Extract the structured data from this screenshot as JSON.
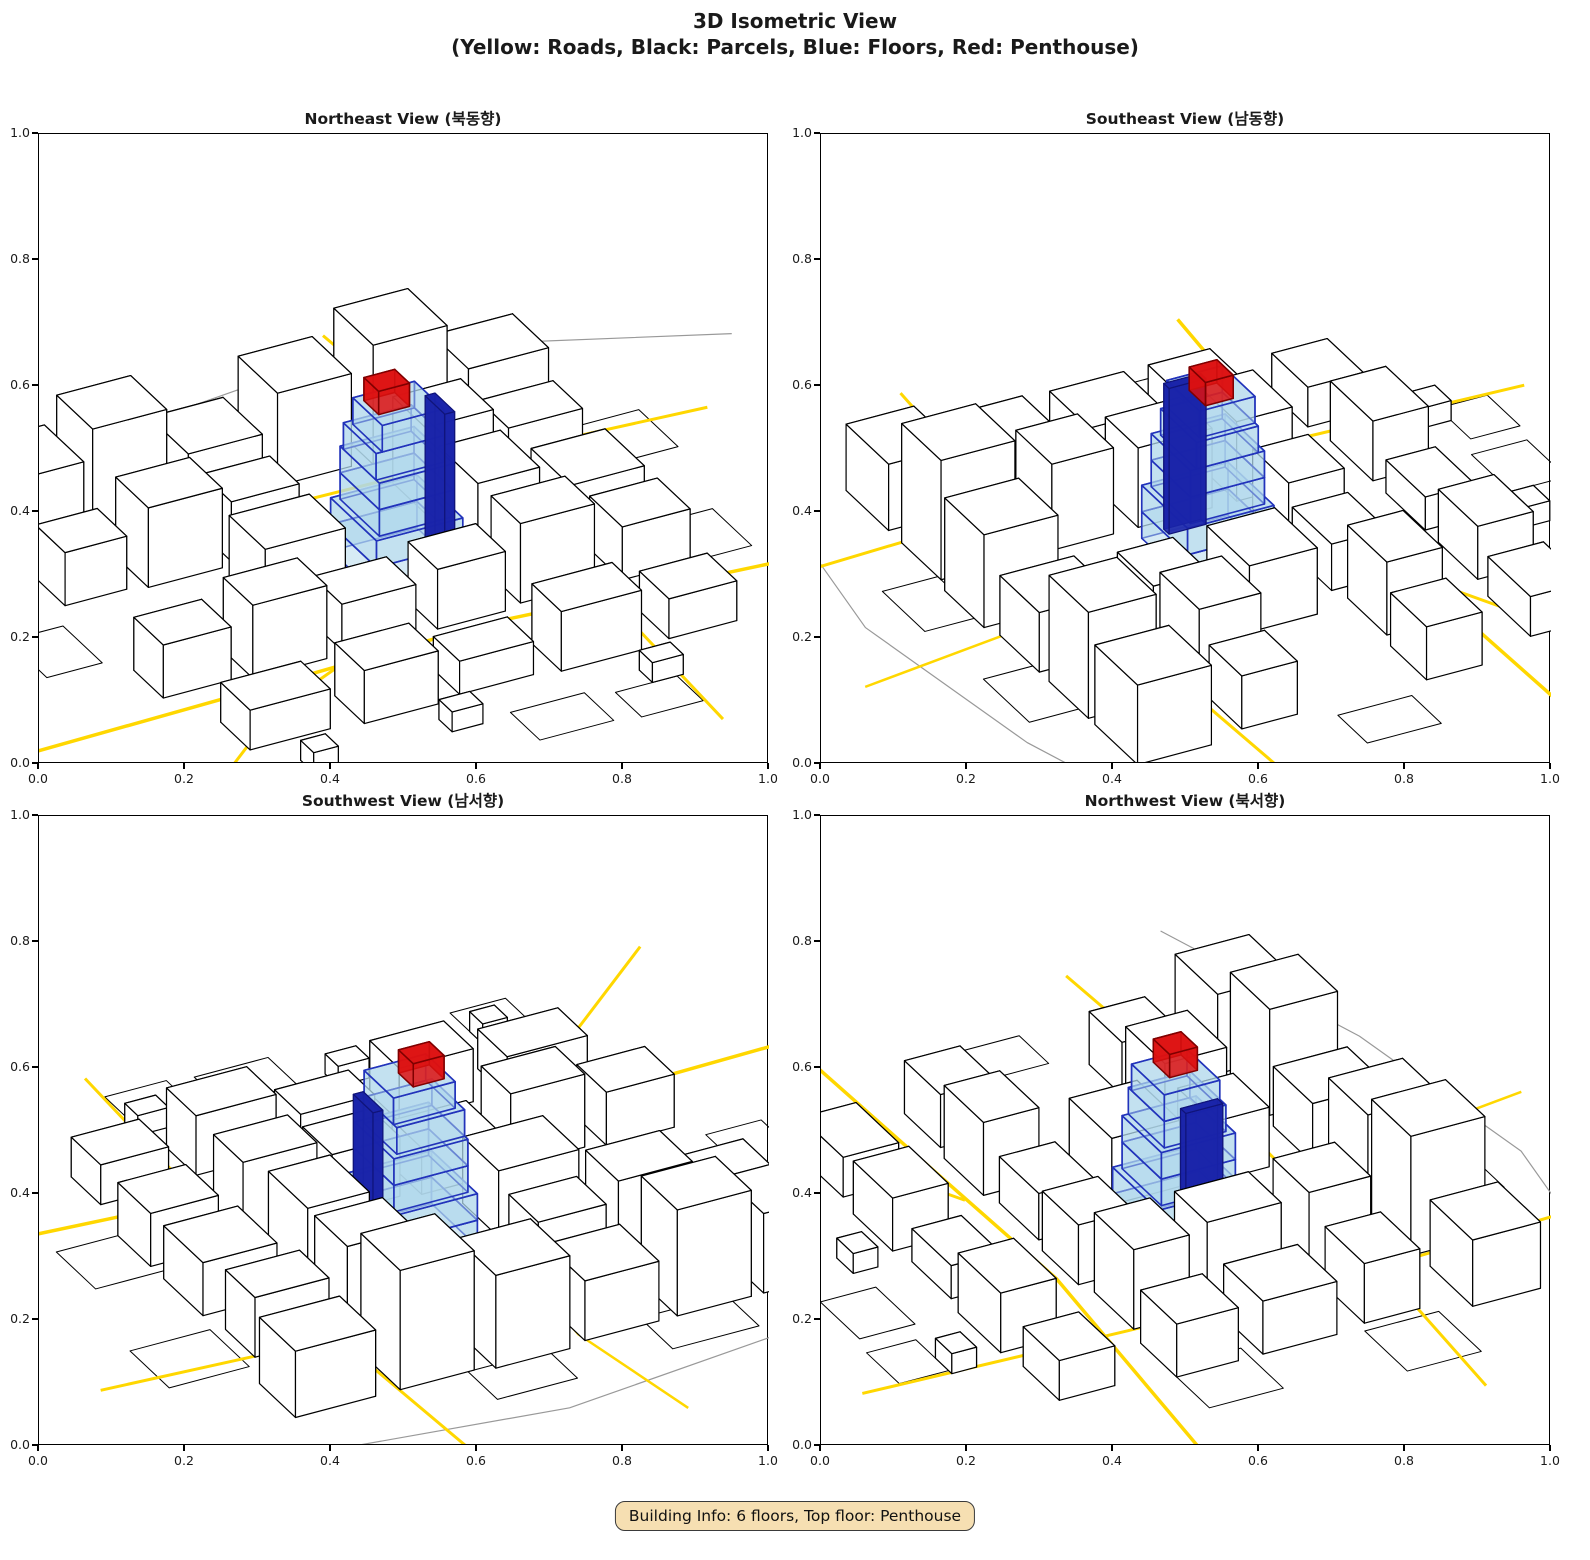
{
  "figure": {
    "title_line1": "3D Isometric View",
    "title_line2": "(Yellow: Roads, Black: Parcels, Blue: Floors, Red: Penthouse)"
  },
  "badge": {
    "text": "Building Info: 6 floors, Top floor: Penthouse"
  },
  "axes": {
    "ticks": [
      "0.0",
      "0.2",
      "0.4",
      "0.6",
      "0.8",
      "1.0"
    ]
  },
  "views": [
    {
      "id": "northeast",
      "title": "Northeast View (북동향)",
      "azimuth": 28,
      "origin": [
        0.49,
        0.68
      ]
    },
    {
      "id": "southeast",
      "title": "Southeast View (남동향)",
      "azimuth": 118,
      "origin": [
        0.53,
        0.66
      ]
    },
    {
      "id": "southwest",
      "title": "Southwest View (남서향)",
      "azimuth": 208,
      "origin": [
        0.51,
        0.67
      ]
    },
    {
      "id": "northwest",
      "title": "Northwest View (북서향)",
      "azimuth": 298,
      "origin": [
        0.49,
        0.66
      ]
    }
  ],
  "colors": {
    "road": "#FFD700",
    "parcel_line": "#000000",
    "building_fill": "#FFFFFF",
    "building_edge": "#000000",
    "floor_fill": "rgba(176,216,235,0.5)",
    "floor_edge": "#2233BB",
    "core_fill": "rgba(25,35,170,0.9)",
    "core_edge": "#10147A",
    "penthouse_fill": "rgba(221,17,17,0.85)",
    "penthouse_edge": "#7F0000",
    "boundary": "#999999"
  },
  "city": {
    "scale": 7.0,
    "tilt": 0.5,
    "hz": 0.95,
    "center": [
      52,
      50
    ],
    "roads": [
      {
        "width": 3.5,
        "pts": [
          [
            -20,
            26
          ],
          [
            20,
            27
          ],
          [
            56,
            28
          ],
          [
            112,
            23
          ]
        ]
      },
      {
        "width": 3.0,
        "pts": [
          [
            -16,
            -8
          ],
          [
            16,
            20
          ],
          [
            30,
            27
          ]
        ]
      },
      {
        "width": 3.0,
        "pts": [
          [
            -20,
            70
          ],
          [
            30,
            72
          ],
          [
            70,
            71
          ],
          [
            112,
            68
          ]
        ]
      },
      {
        "width": 3.0,
        "pts": [
          [
            72,
            -12
          ],
          [
            74,
            30
          ],
          [
            75,
            70
          ],
          [
            73,
            112
          ]
        ]
      },
      {
        "width": 2.5,
        "pts": [
          [
            40,
            112
          ],
          [
            44,
            86
          ],
          [
            43,
            74
          ]
        ]
      }
    ],
    "boundaries": [
      {
        "width": 1.2,
        "pts": [
          [
            -25,
            88
          ],
          [
            15,
            99
          ],
          [
            55,
            104
          ],
          [
            95,
            98
          ],
          [
            125,
            85
          ]
        ]
      }
    ],
    "parcels": [
      [
        46,
        -5,
        12,
        9
      ],
      [
        62,
        -6,
        10,
        8
      ],
      [
        8,
        -4,
        9,
        7
      ],
      [
        86,
        30,
        13,
        12
      ],
      [
        -8,
        44,
        9,
        12
      ],
      [
        90,
        60,
        13,
        12
      ],
      [
        20,
        86,
        14,
        10
      ],
      [
        50,
        88,
        13,
        9
      ]
    ],
    "buildings": [
      [
        2,
        76,
        13,
        12,
        12
      ],
      [
        17,
        77,
        12,
        11,
        16
      ],
      [
        32,
        76,
        12,
        12,
        9
      ],
      [
        47,
        77,
        12,
        12,
        14
      ],
      [
        62,
        76,
        12,
        12,
        18
      ],
      [
        78,
        77,
        13,
        11,
        10
      ],
      [
        4,
        61,
        10,
        9,
        8
      ],
      [
        17,
        60,
        12,
        10,
        12
      ],
      [
        31,
        61,
        11,
        9,
        9
      ],
      [
        62,
        60,
        11,
        10,
        13
      ],
      [
        76,
        61,
        12,
        9,
        9
      ],
      [
        28,
        45,
        13,
        11,
        10
      ],
      [
        62,
        44,
        10,
        12,
        12
      ],
      [
        77,
        44,
        12,
        12,
        8
      ],
      [
        4,
        31,
        11,
        9,
        8
      ],
      [
        18,
        30,
        12,
        9,
        11
      ],
      [
        33,
        31,
        12,
        9,
        7
      ],
      [
        48,
        30,
        11,
        9,
        9
      ],
      [
        62,
        31,
        12,
        9,
        12
      ],
      [
        78,
        30,
        11,
        10,
        8
      ],
      [
        8,
        12,
        13,
        9,
        6
      ],
      [
        26,
        11,
        12,
        9,
        8
      ],
      [
        42,
        12,
        12,
        8,
        5
      ],
      [
        58,
        11,
        13,
        9,
        9
      ],
      [
        76,
        12,
        11,
        9,
        6
      ],
      [
        36,
        3,
        5,
        4,
        3
      ],
      [
        13,
        2,
        4,
        4,
        3
      ],
      [
        68,
        2,
        5,
        4,
        3
      ]
    ],
    "subject": {
      "floors": [
        [
          45,
          43,
          14,
          14,
          0,
          4
        ],
        [
          45,
          43,
          14,
          14,
          4,
          8
        ],
        [
          46,
          44,
          12,
          12,
          8,
          12
        ],
        [
          46,
          44,
          12,
          12,
          12,
          16
        ],
        [
          46,
          45,
          11,
          10,
          16,
          20
        ],
        [
          47,
          45,
          10,
          9,
          20,
          24
        ]
      ],
      "core": [
        58.2,
        47,
        1.6,
        6,
        0,
        22
      ],
      "penthouse": [
        48,
        48,
        5,
        4.5,
        24,
        27.5
      ]
    }
  },
  "chart_data": {
    "type": "3d-isometric-multiview",
    "title": "3D Isometric View",
    "subtitle": "(Yellow: Roads, Black: Parcels, Blue: Floors, Red: Penthouse)",
    "legend": {
      "Yellow": "Roads",
      "Black": "Parcels",
      "Blue": "Floors",
      "Red": "Penthouse"
    },
    "views": [
      "Northeast View (북동향)",
      "Southeast View (남동향)",
      "Southwest View (남서향)",
      "Northwest View (북서향)"
    ],
    "axis": {
      "xlim": [
        0.0,
        1.0
      ],
      "ylim": [
        0.0,
        1.0
      ],
      "ticks": [
        0.0,
        0.2,
        0.4,
        0.6,
        0.8,
        1.0
      ]
    },
    "building_info": {
      "floors": 6,
      "top_floor": "Penthouse"
    }
  }
}
